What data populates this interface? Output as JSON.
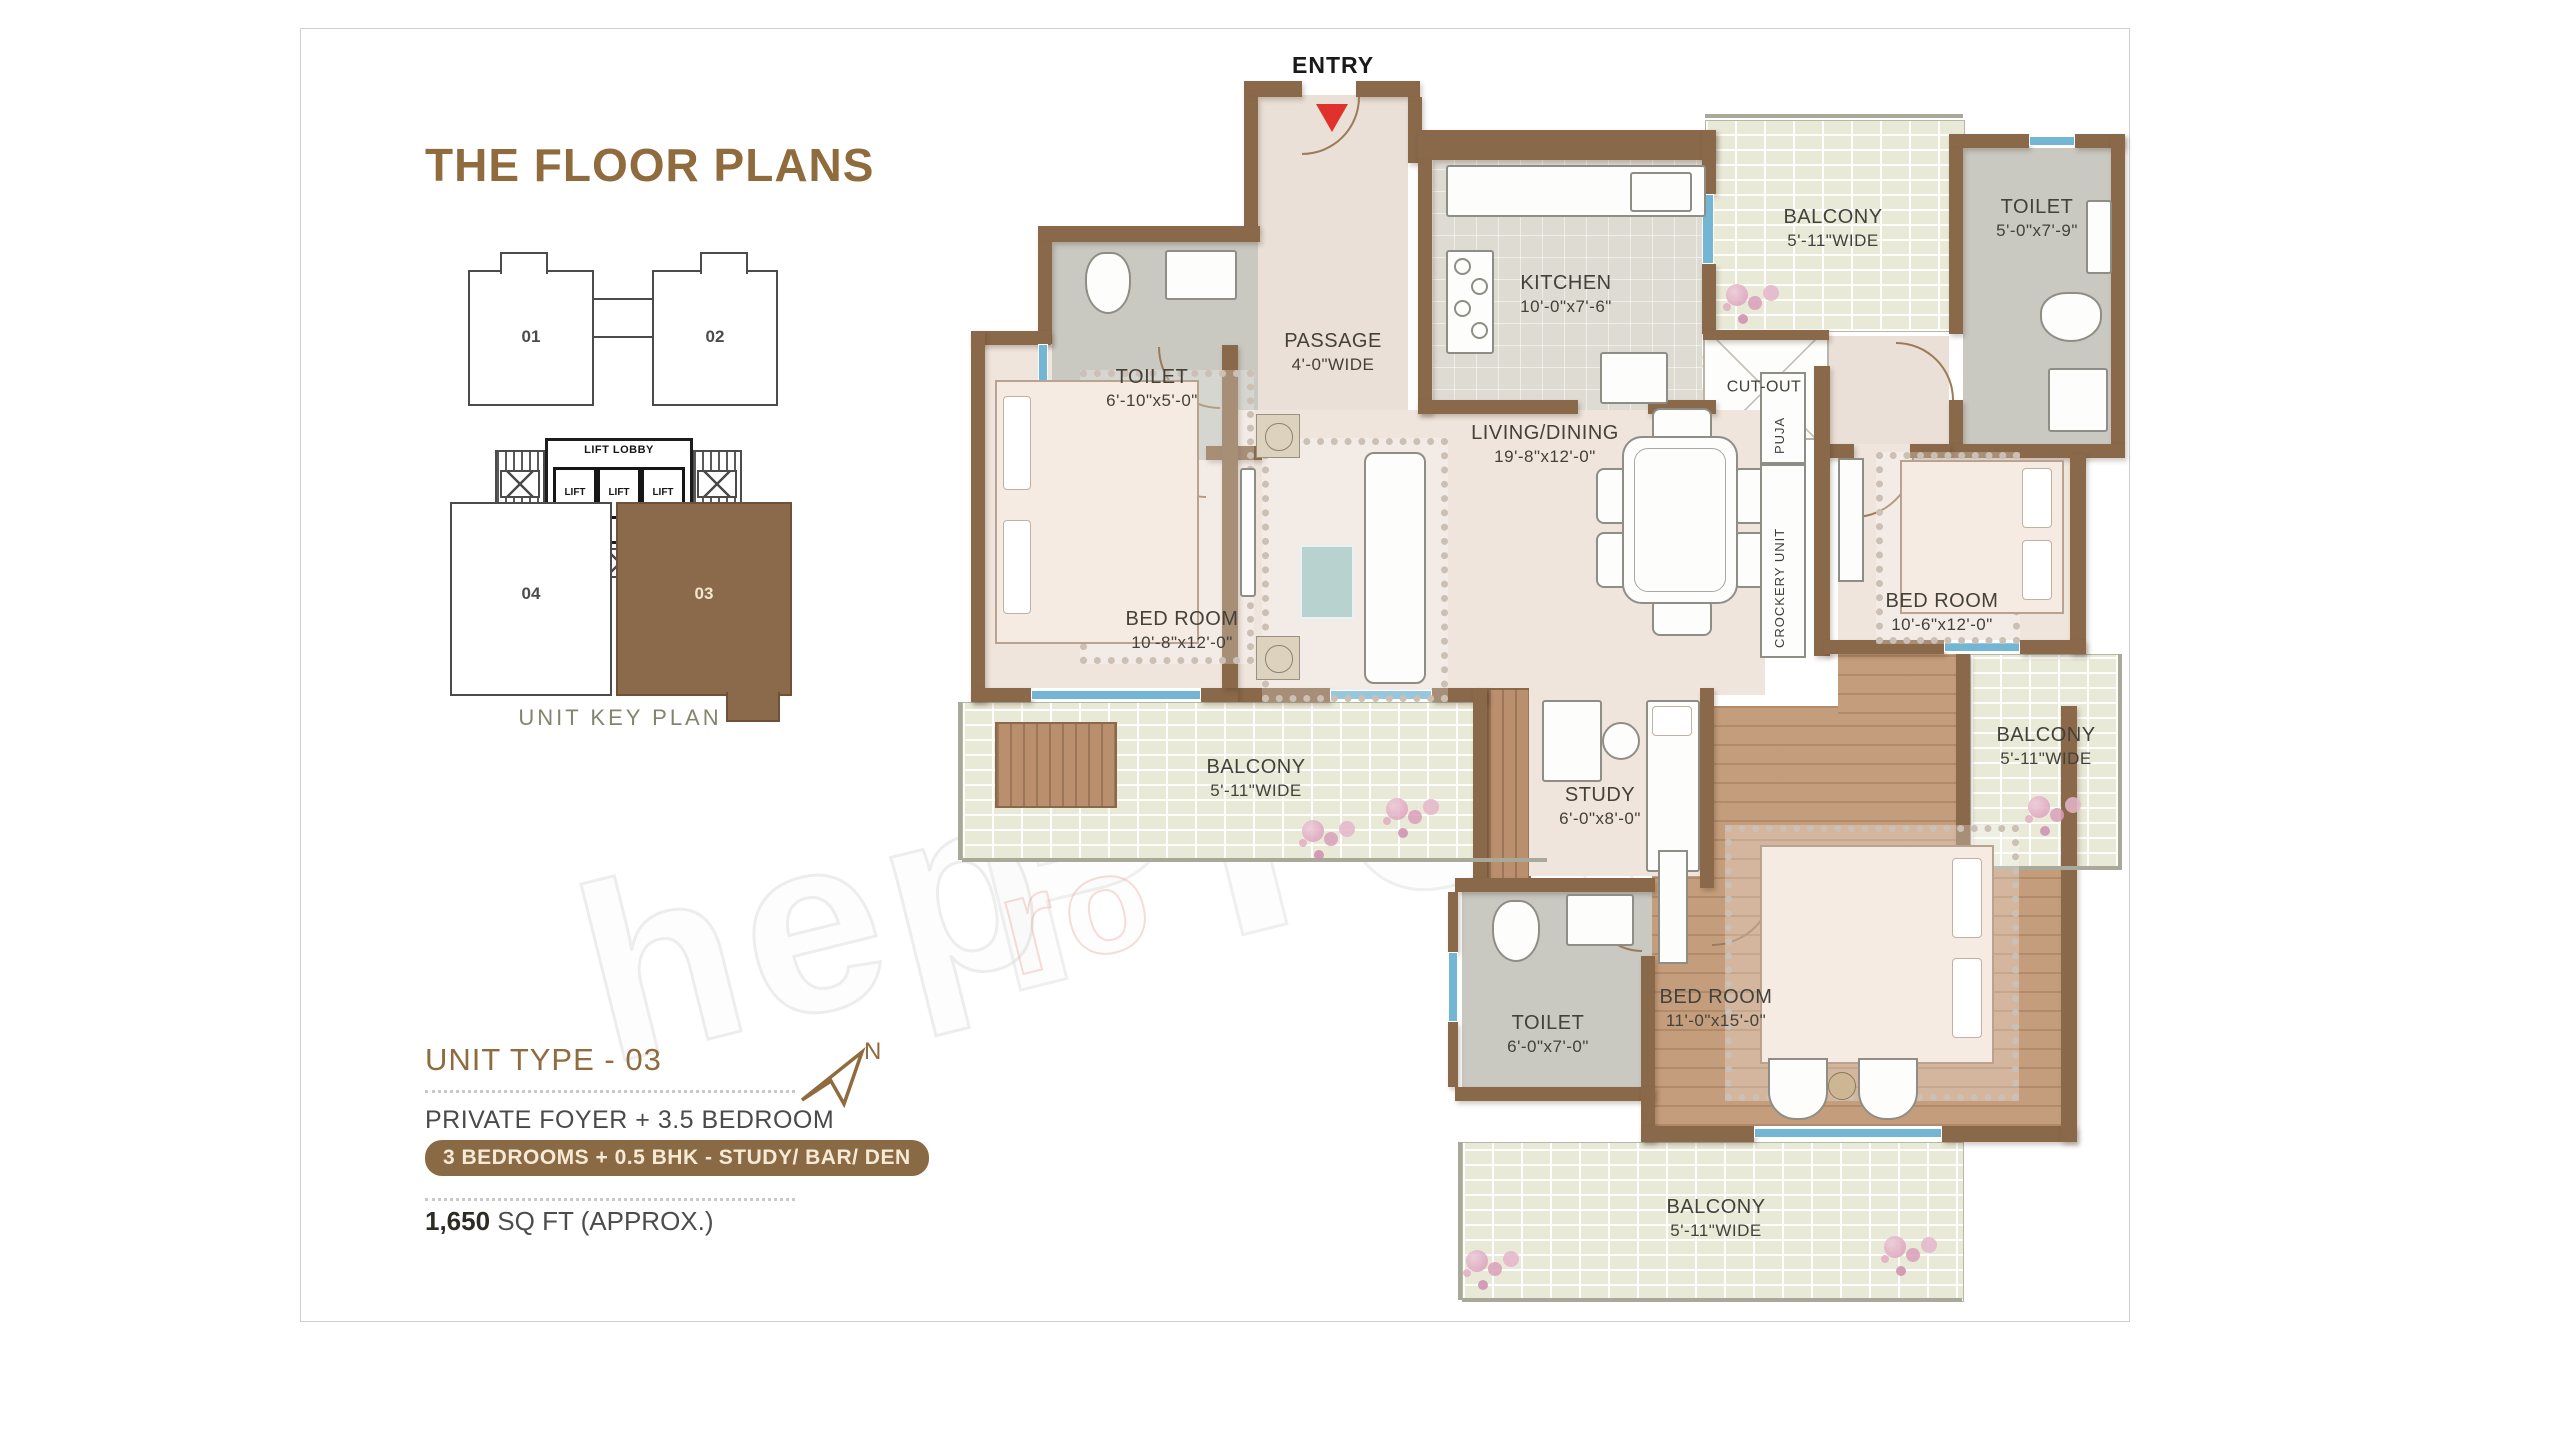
{
  "page": {
    "title": "THE FLOOR PLANS"
  },
  "key_plan": {
    "caption": "UNIT KEY PLAN",
    "lift_lobby_label": "LIFT LOBBY",
    "lift_label": "LIFT",
    "units": [
      {
        "id": "01",
        "label": "01",
        "highlighted": false
      },
      {
        "id": "02",
        "label": "02",
        "highlighted": false
      },
      {
        "id": "04",
        "label": "04",
        "highlighted": false
      },
      {
        "id": "03",
        "label": "03",
        "highlighted": true
      }
    ]
  },
  "unit_info": {
    "unit_type": "UNIT TYPE - 03",
    "config": "PRIVATE FOYER + 3.5 BEDROOM",
    "badge": "3 BEDROOMS + 0.5 BHK  - STUDY/ BAR/ DEN",
    "area_value": "1,650",
    "area_suffix": " SQ FT (APPROX.)",
    "north_label": "N"
  },
  "plan": {
    "entry_label": "ENTRY",
    "rooms": [
      {
        "id": "toilet-top-left",
        "name": "TOILET",
        "dims": "6'-10\"x5'-0\""
      },
      {
        "id": "passage",
        "name": "PASSAGE",
        "dims": "4'-0\"WIDE"
      },
      {
        "id": "kitchen",
        "name": "KITCHEN",
        "dims": "10'-0\"x7'-6\""
      },
      {
        "id": "balcony-top",
        "name": "BALCONY",
        "dims": "5'-11\"WIDE"
      },
      {
        "id": "cut-out",
        "name": "CUT-OUT",
        "dims": ""
      },
      {
        "id": "toilet-top-right",
        "name": "TOILET",
        "dims": "5'-0\"x7'-9\""
      },
      {
        "id": "bedroom-left",
        "name": "BED ROOM",
        "dims": "10'-8\"x12'-0\""
      },
      {
        "id": "living-dining",
        "name": "LIVING/DINING",
        "dims": "19'-8\"x12'-0\""
      },
      {
        "id": "puja",
        "name": "PUJA",
        "dims": ""
      },
      {
        "id": "crockery-unit",
        "name": "CROCKERY UNIT",
        "dims": ""
      },
      {
        "id": "bedroom-right",
        "name": "BED ROOM",
        "dims": "10'-6\"x12'-0\""
      },
      {
        "id": "balcony-left",
        "name": "BALCONY",
        "dims": "5'-11\"WIDE"
      },
      {
        "id": "study",
        "name": "STUDY",
        "dims": "6'-0\"x8'-0\""
      },
      {
        "id": "balcony-right",
        "name": "BALCONY",
        "dims": "5'-11\"WIDE"
      },
      {
        "id": "toilet-bottom",
        "name": "TOILET",
        "dims": "6'-0\"x7'-0\""
      },
      {
        "id": "bedroom-bottom",
        "name": "BED ROOM",
        "dims": "11'-0\"x15'-0\""
      },
      {
        "id": "balcony-bottom",
        "name": "BALCONY",
        "dims": "5'-11\"WIDE"
      }
    ]
  },
  "watermark": {
    "fragments": [
      "hep",
      "Prop",
      "ro",
      "com"
    ]
  },
  "colors": {
    "accent_brown": "#8f6b3e",
    "badge_brown": "#8a6a45",
    "wall_brown": "#8a684a",
    "highlight_unit_fill": "#8a6a4b",
    "entry_arrow_red": "#e0312b",
    "window_blue": "#72b6d4"
  }
}
